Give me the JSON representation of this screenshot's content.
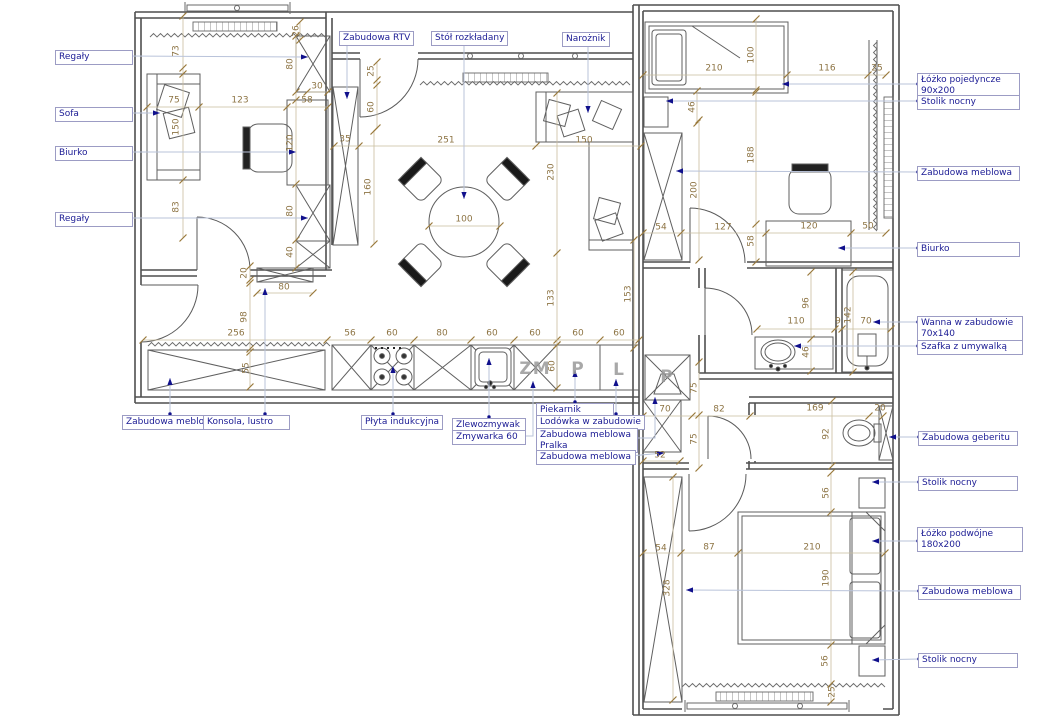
{
  "colors": {
    "label_text": "#1b1b94",
    "label_border": "#9c9cc4",
    "leader": "#b9c3da",
    "marker": "#10108c",
    "dimension": "#8d7444",
    "dim_line": "#c9bd9e",
    "dim_tick": "#9a7a3c",
    "wall": "#4f4f4f",
    "furniture": "#5f5f5f"
  },
  "callouts": [
    {
      "id": "regaly-1",
      "lines": [
        "Regały"
      ],
      "box": [
        55,
        50,
        70
      ],
      "path": [
        [
          126,
          56
        ],
        [
          308,
          57
        ]
      ]
    },
    {
      "id": "sofa",
      "lines": [
        "Sofa"
      ],
      "box": [
        55,
        107,
        70
      ],
      "path": [
        [
          126,
          113
        ],
        [
          160,
          113
        ]
      ]
    },
    {
      "id": "biurko-1",
      "lines": [
        "Biurko"
      ],
      "box": [
        55,
        146,
        70
      ],
      "path": [
        [
          126,
          152
        ],
        [
          296,
          152
        ]
      ]
    },
    {
      "id": "regaly-2",
      "lines": [
        "Regały"
      ],
      "box": [
        55,
        212,
        70
      ],
      "path": [
        [
          126,
          218
        ],
        [
          308,
          218
        ]
      ]
    },
    {
      "id": "zabudowa-rtv",
      "lines": [
        "Zabudowa RTV"
      ],
      "box": [
        339,
        31,
        62
      ],
      "path": [
        [
          347,
          44
        ],
        [
          347,
          99
        ]
      ]
    },
    {
      "id": "stol-rozkladany",
      "lines": [
        "Stół rozkładany"
      ],
      "box": [
        431,
        31,
        67
      ],
      "path": [
        [
          464,
          44
        ],
        [
          464,
          199
        ]
      ]
    },
    {
      "id": "naroznik",
      "lines": [
        "Narożnik"
      ],
      "box": [
        562,
        32,
        40
      ],
      "path": [
        [
          588,
          45
        ],
        [
          588,
          113
        ]
      ]
    },
    {
      "id": "lozko-pojedyncze",
      "lines": [
        "Łóżko pojedyncze",
        "90x200"
      ],
      "box": [
        917,
        73,
        95
      ],
      "path": [
        [
          918,
          84
        ],
        [
          782,
          84
        ]
      ]
    },
    {
      "id": "stolik-nocny-1",
      "lines": [
        "Stolik nocny"
      ],
      "box": [
        917,
        95,
        95
      ],
      "path": [
        [
          918,
          101
        ],
        [
          666,
          101
        ]
      ]
    },
    {
      "id": "zabudowa-meblowa-1",
      "lines": [
        "Zabudowa meblowa"
      ],
      "box": [
        917,
        166,
        95
      ],
      "path": [
        [
          918,
          172
        ],
        [
          676,
          171
        ]
      ]
    },
    {
      "id": "biurko-2",
      "lines": [
        "Biurko"
      ],
      "box": [
        917,
        242,
        95
      ],
      "path": [
        [
          918,
          248
        ],
        [
          838,
          248
        ]
      ]
    },
    {
      "id": "wanna-w-zabudowie",
      "lines": [
        "Wanna w zabudowie",
        "70x140"
      ],
      "box": [
        917,
        316,
        98
      ],
      "path": [
        [
          918,
          322
        ],
        [
          873,
          322
        ]
      ]
    },
    {
      "id": "szafka-z-umywalka",
      "lines": [
        "Szafka z umywalką"
      ],
      "box": [
        917,
        340,
        98
      ],
      "path": [
        [
          918,
          346
        ],
        [
          794,
          346
        ]
      ]
    },
    {
      "id": "zabudowa-geberitu",
      "lines": [
        "Zabudowa geberitu"
      ],
      "box": [
        918,
        431,
        92
      ],
      "path": [
        [
          919,
          437
        ],
        [
          889,
          437
        ]
      ]
    },
    {
      "id": "stolik-nocny-2",
      "lines": [
        "Stolik nocny"
      ],
      "box": [
        918,
        476,
        92
      ],
      "path": [
        [
          919,
          482
        ],
        [
          872,
          482
        ]
      ]
    },
    {
      "id": "lozko-podwojne",
      "lines": [
        "Łóżko podwójne",
        "180x200"
      ],
      "box": [
        917,
        527,
        98
      ],
      "path": [
        [
          918,
          541
        ],
        [
          872,
          541
        ]
      ]
    },
    {
      "id": "zabudowa-meblowa-2",
      "lines": [
        "Zabudowa meblowa"
      ],
      "box": [
        918,
        585,
        95
      ],
      "path": [
        [
          919,
          591
        ],
        [
          686,
          590
        ]
      ]
    },
    {
      "id": "stolik-nocny-3",
      "lines": [
        "Stolik nocny"
      ],
      "box": [
        918,
        653,
        92
      ],
      "path": [
        [
          919,
          659
        ],
        [
          872,
          660
        ]
      ]
    },
    {
      "id": "zabudowa-meblowa-3",
      "lines": [
        "Zabudowa meblowa"
      ],
      "box": [
        122,
        415,
        76
      ],
      "path": [
        [
          170,
          414
        ],
        [
          170,
          378
        ]
      ]
    },
    {
      "id": "konsola-lustro",
      "lines": [
        "Konsola, lustro"
      ],
      "box": [
        203,
        415,
        79
      ],
      "path": [
        [
          265,
          414
        ],
        [
          265,
          288
        ]
      ]
    },
    {
      "id": "plyta-indukcyjna",
      "lines": [
        "Płyta indukcyjna"
      ],
      "box": [
        361,
        415,
        64
      ],
      "path": [
        [
          393,
          414
        ],
        [
          393,
          366
        ]
      ]
    },
    {
      "id": "zlewozmywak",
      "lines": [
        "Zlewozmywak"
      ],
      "box": [
        452,
        418,
        66
      ],
      "path": [
        [
          489,
          417
        ],
        [
          489,
          358
        ]
      ]
    },
    {
      "id": "zmywarka-60",
      "lines": [
        "Zmywarka 60"
      ],
      "box": [
        452,
        430,
        66
      ],
      "path": [
        [
          518,
          436
        ],
        [
          533,
          436
        ],
        [
          533,
          381
        ]
      ]
    },
    {
      "id": "piekarnik",
      "lines": [
        "Piekarnik"
      ],
      "box": [
        536,
        403,
        70
      ],
      "path": [
        [
          575,
          402
        ],
        [
          575,
          370
        ]
      ]
    },
    {
      "id": "lodowka-w-zabudowie",
      "lines": [
        "Lodówka w zabudowie"
      ],
      "box": [
        536,
        415,
        87
      ],
      "path": [
        [
          616,
          414
        ],
        [
          616,
          379
        ]
      ]
    },
    {
      "id": "zabudowa-meblowa-pralka",
      "lines": [
        "Zabudowa meblowa",
        "Pralka"
      ],
      "box": [
        536,
        428,
        94
      ],
      "path": [
        [
          631,
          438
        ],
        [
          655,
          438
        ],
        [
          655,
          397
        ]
      ]
    },
    {
      "id": "zabudowa-meblowa-4",
      "lines": [
        "Zabudowa meblowa"
      ],
      "box": [
        536,
        450,
        92
      ],
      "path": [
        [
          629,
          456
        ],
        [
          664,
          453
        ]
      ]
    }
  ],
  "dimensions": [
    {
      "v": "73",
      "x": 177,
      "y": 51,
      "o": "v"
    },
    {
      "v": "26",
      "x": 297,
      "y": 31,
      "o": "v"
    },
    {
      "v": "80",
      "x": 291,
      "y": 64,
      "o": "v"
    },
    {
      "v": "30",
      "x": 317,
      "y": 87,
      "o": "h"
    },
    {
      "v": "58",
      "x": 307,
      "y": 101,
      "o": "h"
    },
    {
      "v": "75",
      "x": 174,
      "y": 101,
      "o": "h"
    },
    {
      "v": "123",
      "x": 240,
      "y": 101,
      "o": "h"
    },
    {
      "v": "150",
      "x": 177,
      "y": 127,
      "o": "v"
    },
    {
      "v": "120",
      "x": 291,
      "y": 143,
      "o": "v"
    },
    {
      "v": "35",
      "x": 345,
      "y": 140,
      "o": "h"
    },
    {
      "v": "25",
      "x": 372,
      "y": 71,
      "o": "v"
    },
    {
      "v": "60",
      "x": 372,
      "y": 107,
      "o": "v"
    },
    {
      "v": "160",
      "x": 369,
      "y": 187,
      "o": "v"
    },
    {
      "v": "251",
      "x": 446,
      "y": 141,
      "o": "h"
    },
    {
      "v": "150",
      "x": 584,
      "y": 141,
      "o": "h"
    },
    {
      "v": "230",
      "x": 552,
      "y": 172,
      "o": "v"
    },
    {
      "v": "100",
      "x": 464,
      "y": 220,
      "o": "h"
    },
    {
      "v": "133",
      "x": 552,
      "y": 298,
      "o": "v"
    },
    {
      "v": "153",
      "x": 629,
      "y": 294,
      "o": "v"
    },
    {
      "v": "83",
      "x": 177,
      "y": 207,
      "o": "v"
    },
    {
      "v": "80",
      "x": 291,
      "y": 211,
      "o": "v"
    },
    {
      "v": "40",
      "x": 291,
      "y": 252,
      "o": "v"
    },
    {
      "v": "20",
      "x": 245,
      "y": 273,
      "o": "v"
    },
    {
      "v": "80",
      "x": 284,
      "y": 288,
      "o": "h"
    },
    {
      "v": "98",
      "x": 245,
      "y": 317,
      "o": "v"
    },
    {
      "v": "256",
      "x": 236,
      "y": 334,
      "o": "h"
    },
    {
      "v": "55",
      "x": 247,
      "y": 368,
      "o": "v"
    },
    {
      "v": "56",
      "x": 350,
      "y": 334,
      "o": "h"
    },
    {
      "v": "60",
      "x": 392,
      "y": 334,
      "o": "h"
    },
    {
      "v": "80",
      "x": 442,
      "y": 334,
      "o": "h"
    },
    {
      "v": "60",
      "x": 492,
      "y": 334,
      "o": "h"
    },
    {
      "v": "60",
      "x": 535,
      "y": 334,
      "o": "h"
    },
    {
      "v": "60",
      "x": 578,
      "y": 334,
      "o": "h"
    },
    {
      "v": "60",
      "x": 619,
      "y": 334,
      "o": "h"
    },
    {
      "v": "60",
      "x": 553,
      "y": 366,
      "o": "v"
    },
    {
      "v": "210",
      "x": 714,
      "y": 69,
      "o": "h"
    },
    {
      "v": "100",
      "x": 752,
      "y": 55,
      "o": "v"
    },
    {
      "v": "116",
      "x": 827,
      "y": 69,
      "o": "h"
    },
    {
      "v": "25",
      "x": 877,
      "y": 69,
      "o": "h"
    },
    {
      "v": "46",
      "x": 693,
      "y": 107,
      "o": "v"
    },
    {
      "v": "188",
      "x": 752,
      "y": 155,
      "o": "v"
    },
    {
      "v": "200",
      "x": 695,
      "y": 190,
      "o": "v"
    },
    {
      "v": "54",
      "x": 661,
      "y": 228,
      "o": "h"
    },
    {
      "v": "127",
      "x": 723,
      "y": 228,
      "o": "h"
    },
    {
      "v": "58",
      "x": 752,
      "y": 241,
      "o": "v"
    },
    {
      "v": "120",
      "x": 809,
      "y": 227,
      "o": "h"
    },
    {
      "v": "50",
      "x": 868,
      "y": 227,
      "o": "h"
    },
    {
      "v": "96",
      "x": 807,
      "y": 303,
      "o": "v"
    },
    {
      "v": "110",
      "x": 796,
      "y": 322,
      "o": "h"
    },
    {
      "v": "9",
      "x": 838,
      "y": 322,
      "o": "h"
    },
    {
      "v": "142",
      "x": 849,
      "y": 315,
      "o": "v"
    },
    {
      "v": "70",
      "x": 866,
      "y": 322,
      "o": "h"
    },
    {
      "v": "46",
      "x": 807,
      "y": 352,
      "o": "v"
    },
    {
      "v": "75",
      "x": 695,
      "y": 388,
      "o": "v"
    },
    {
      "v": "70",
      "x": 665,
      "y": 410,
      "o": "h"
    },
    {
      "v": "82",
      "x": 719,
      "y": 410,
      "o": "h"
    },
    {
      "v": "169",
      "x": 815,
      "y": 409,
      "o": "h"
    },
    {
      "v": "20",
      "x": 880,
      "y": 409,
      "o": "h"
    },
    {
      "v": "75",
      "x": 695,
      "y": 439,
      "o": "v"
    },
    {
      "v": "52",
      "x": 660,
      "y": 456,
      "o": "h"
    },
    {
      "v": "92",
      "x": 827,
      "y": 434,
      "o": "v"
    },
    {
      "v": "56",
      "x": 827,
      "y": 493,
      "o": "v"
    },
    {
      "v": "54",
      "x": 661,
      "y": 549,
      "o": "h"
    },
    {
      "v": "87",
      "x": 709,
      "y": 548,
      "o": "h"
    },
    {
      "v": "210",
      "x": 812,
      "y": 548,
      "o": "h"
    },
    {
      "v": "328",
      "x": 668,
      "y": 588,
      "o": "v"
    },
    {
      "v": "190",
      "x": 827,
      "y": 578,
      "o": "v"
    },
    {
      "v": "56",
      "x": 826,
      "y": 661,
      "o": "v"
    },
    {
      "v": "25",
      "x": 833,
      "y": 692,
      "o": "v"
    }
  ],
  "appliances": [
    {
      "code": "ZM",
      "x": 535,
      "y": 369
    },
    {
      "code": "P",
      "x": 578,
      "y": 369
    },
    {
      "code": "L",
      "x": 619,
      "y": 370
    },
    {
      "code": "P",
      "x": 667,
      "y": 377
    }
  ]
}
